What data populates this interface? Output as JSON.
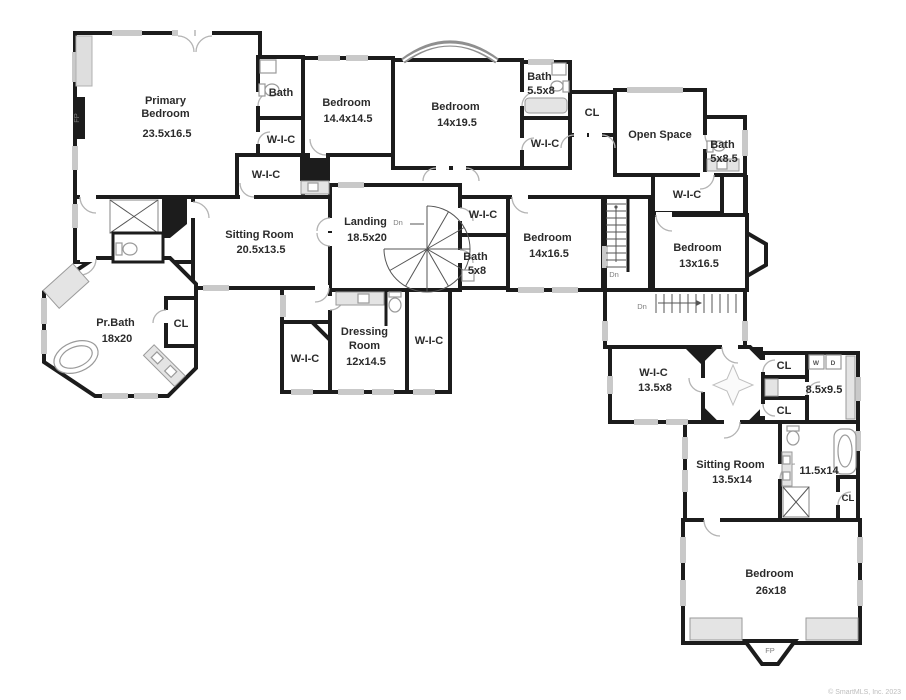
{
  "page": {
    "copyright": "© SmartMLS, Inc. 2023"
  },
  "colors": {
    "wall": "#1c1c1c",
    "window": "#c9c9c9",
    "door_arc": "#b3b3b3",
    "text": "#2b2b2b",
    "background": "#ffffff"
  },
  "rooms": {
    "primary_bedroom": {
      "lines": [
        "Primary",
        "Bedroom",
        "23.5x16.5"
      ]
    },
    "bath_primary_hall": {
      "lines": [
        "Bath"
      ]
    },
    "wic_primary_1": {
      "lines": [
        "W-I-C"
      ]
    },
    "wic_primary_2": {
      "lines": [
        "W-I-C"
      ]
    },
    "bedroom_14_4x14_5": {
      "lines": [
        "Bedroom",
        "14.4x14.5"
      ]
    },
    "bedroom_14x19_5": {
      "lines": [
        "Bedroom",
        "14x19.5"
      ]
    },
    "bath_5_5x8": {
      "lines": [
        "Bath",
        "5.5x8"
      ]
    },
    "wic_center_top": {
      "lines": [
        "W-I-C"
      ]
    },
    "cl_hall_top": {
      "lines": [
        "CL"
      ]
    },
    "open_space": {
      "lines": [
        "Open Space"
      ]
    },
    "bath_5x8_5": {
      "lines": [
        "Bath",
        "5x8.5"
      ]
    },
    "wic_open_space": {
      "lines": [
        "W-I-C"
      ]
    },
    "sitting_room_1": {
      "lines": [
        "Sitting Room",
        "20.5x13.5"
      ]
    },
    "landing": {
      "lines": [
        "Landing",
        "18.5x20"
      ]
    },
    "wic_landing": {
      "lines": [
        "W-I-C"
      ]
    },
    "bath_5x8": {
      "lines": [
        "Bath",
        "5x8"
      ]
    },
    "bedroom_14x16_5": {
      "lines": [
        "Bedroom",
        "14x16.5"
      ]
    },
    "bedroom_13x16_5": {
      "lines": [
        "Bedroom",
        "13x16.5"
      ]
    },
    "pr_bath": {
      "lines": [
        "Pr.Bath",
        "18x20"
      ]
    },
    "cl_pr_bath": {
      "lines": [
        "CL"
      ]
    },
    "wic_dressing_left": {
      "lines": [
        "W-I-C"
      ]
    },
    "dressing_room": {
      "lines": [
        "Dressing",
        "Room",
        "12x14.5"
      ]
    },
    "wic_dressing_right": {
      "lines": [
        "W-I-C"
      ]
    },
    "wic_13_5x8": {
      "lines": [
        "W-I-C",
        "13.5x8"
      ]
    },
    "cl_upper": {
      "lines": [
        "CL"
      ]
    },
    "cl_lower": {
      "lines": [
        "CL"
      ]
    },
    "laundry_8_5x9_5": {
      "lines": [
        "8.5x9.5"
      ]
    },
    "sitting_room_2": {
      "lines": [
        "Sitting Room",
        "13.5x14"
      ]
    },
    "bath_11_5x14": {
      "lines": [
        "11.5x14"
      ]
    },
    "cl_bath_2": {
      "lines": [
        "CL"
      ]
    },
    "bedroom_26x18": {
      "lines": [
        "Bedroom",
        "26x18"
      ]
    }
  },
  "annotations": {
    "dn": "Dn",
    "fp": "FP",
    "washer": "W",
    "dryer": "D"
  }
}
